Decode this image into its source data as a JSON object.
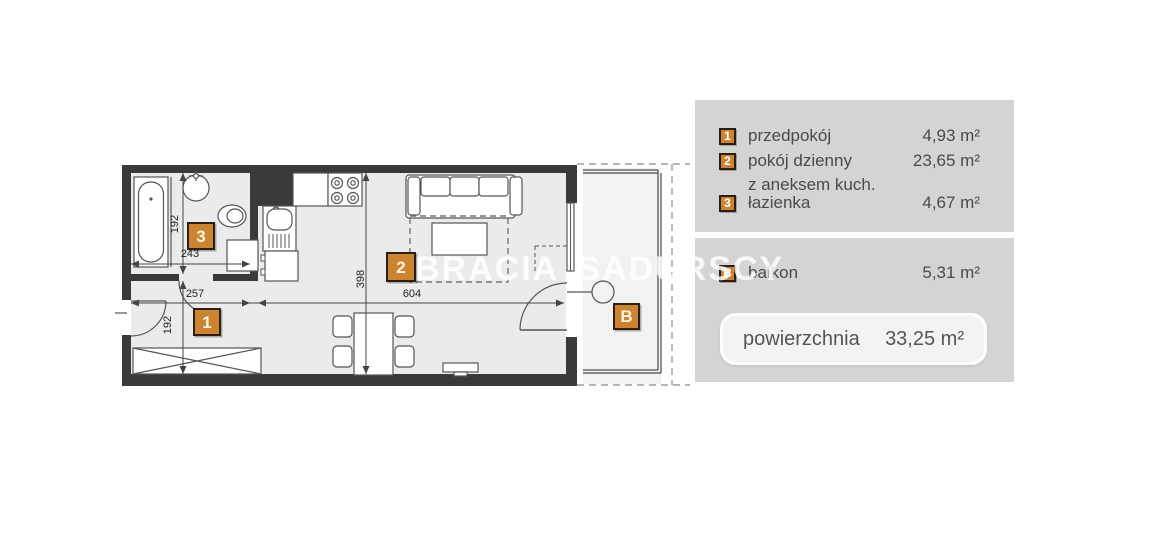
{
  "watermark": "BRACIA SADURSCY",
  "plan": {
    "badge_1": "1",
    "badge_2": "2",
    "badge_3": "3",
    "badge_b": "B",
    "dims": {
      "bath_height": "192",
      "bath_width": "243",
      "hall_width": "257",
      "hall_height": "192",
      "living_height": "398",
      "living_width": "604"
    }
  },
  "legend": {
    "rooms": [
      {
        "num": "1",
        "name": "przedpokój",
        "area": "4,93 m²"
      },
      {
        "num": "2",
        "name": "pokój dzienny",
        "name_line2": "z aneksem kuch.",
        "area": "23,65 m²"
      },
      {
        "num": "3",
        "name": "łazienka",
        "area": "4,67 m²"
      }
    ],
    "balcony": {
      "num": "B",
      "name": "balkon",
      "area": "5,31 m²"
    },
    "total": {
      "label": "powierzchnia",
      "value": "33,25 m²"
    }
  }
}
